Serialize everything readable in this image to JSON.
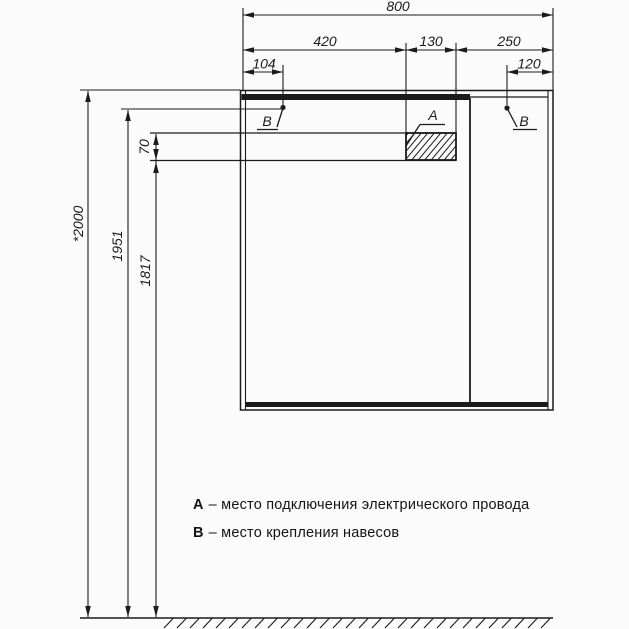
{
  "dims": {
    "total_width": "800",
    "left_section": "420",
    "cutout_width": "130",
    "right_section": "250",
    "left_hinge_offset": "104",
    "right_hinge_offset": "120",
    "total_height": "*2000",
    "hinge_height": "1951",
    "shelf_bottom_height": "1817",
    "shelf_thickness": "70"
  },
  "markers": {
    "a": "A",
    "b": "B"
  },
  "legend": {
    "a_letter": "А",
    "a_desc": "– место подключения электрического провода",
    "b_letter": "В",
    "b_desc": "– место крепления навесов"
  },
  "colors": {
    "ink": "#1b1b1b",
    "paper": "#fbfbfb"
  }
}
